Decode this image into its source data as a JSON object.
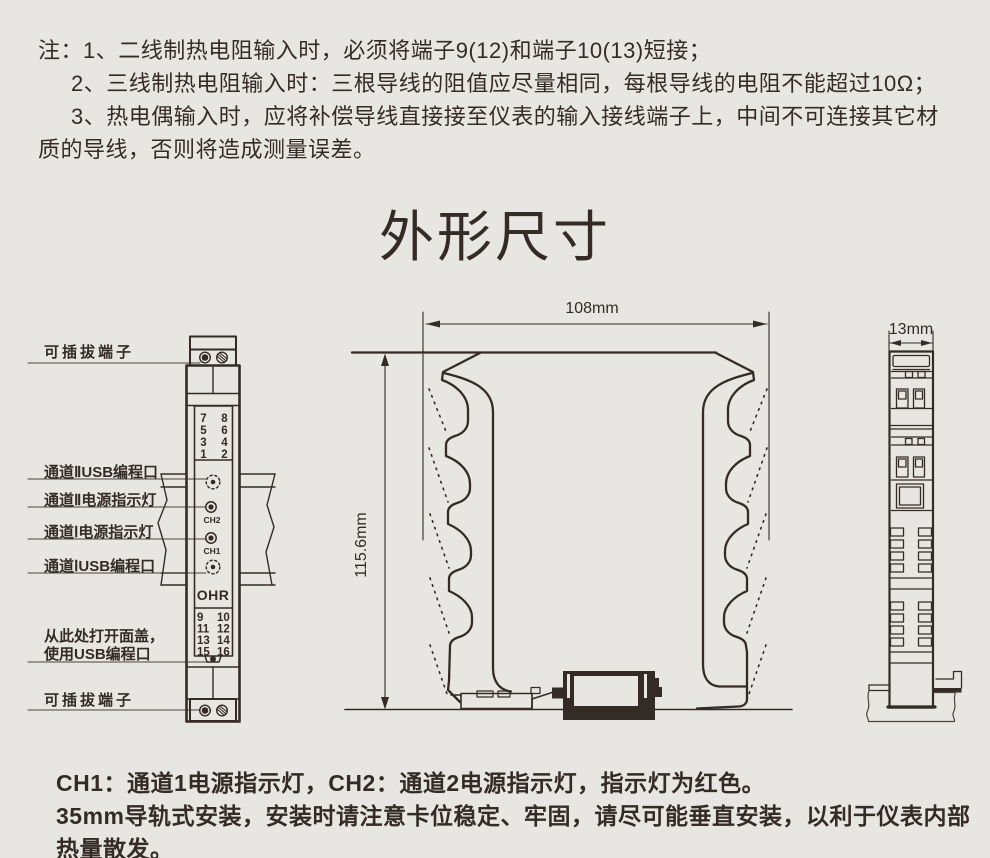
{
  "notes": {
    "line1": "注：1、二线制热电阻输入时，必须将端子9(12)和端子10(13)短接；",
    "line2": "2、三线制热电阻输入时：三根导线的阻值应尽量相同，每根导线的电阻不能超过10Ω；",
    "line3": "3、热电偶输入时，应将补偿导线直接接至仪表的输入接线端子上，中间不可连接其它材",
    "line4": "质的导线，否则将造成测量误差。"
  },
  "title": "外形尺寸",
  "front_view": {
    "labels": {
      "pluggable_terminal_top": "可插拔端子",
      "ch2_usb_port": "通道ⅡUSB编程口",
      "ch2_power_led": "通道Ⅱ电源指示灯",
      "ch1_power_led": "通道Ⅰ电源指示灯",
      "ch1_usb_port": "通道ⅠUSB编程口",
      "open_cover_line1": "从此处打开面盖，",
      "open_cover_line2": "使用USB编程口",
      "pluggable_terminal_bottom": "可插拔端子"
    },
    "brand": "OHR",
    "ch2_label": "CH2",
    "ch1_label": "CH1",
    "terminals_top": [
      [
        "7",
        "8"
      ],
      [
        "5",
        "6"
      ],
      [
        "3",
        "4"
      ],
      [
        "1",
        "2"
      ]
    ],
    "terminals_bottom": [
      [
        "9",
        "10"
      ],
      [
        "11",
        "12"
      ],
      [
        "13",
        "14"
      ],
      [
        "15",
        "16"
      ]
    ]
  },
  "dimensions": {
    "width": "108mm",
    "height": "115.6mm",
    "depth": "13mm"
  },
  "footer": {
    "line1": "CH1：通道1电源指示灯，CH2：通道2电源指示灯，指示灯为红色。",
    "line2": "35mm导轨式安装，安装时请注意卡位稳定、牢固，请尽可能垂直安装，以利于仪表内部",
    "line3": "热量散发。"
  },
  "colors": {
    "background": "#e8e6e3",
    "ink": "#342b27",
    "indicator_color_note": "红色"
  }
}
